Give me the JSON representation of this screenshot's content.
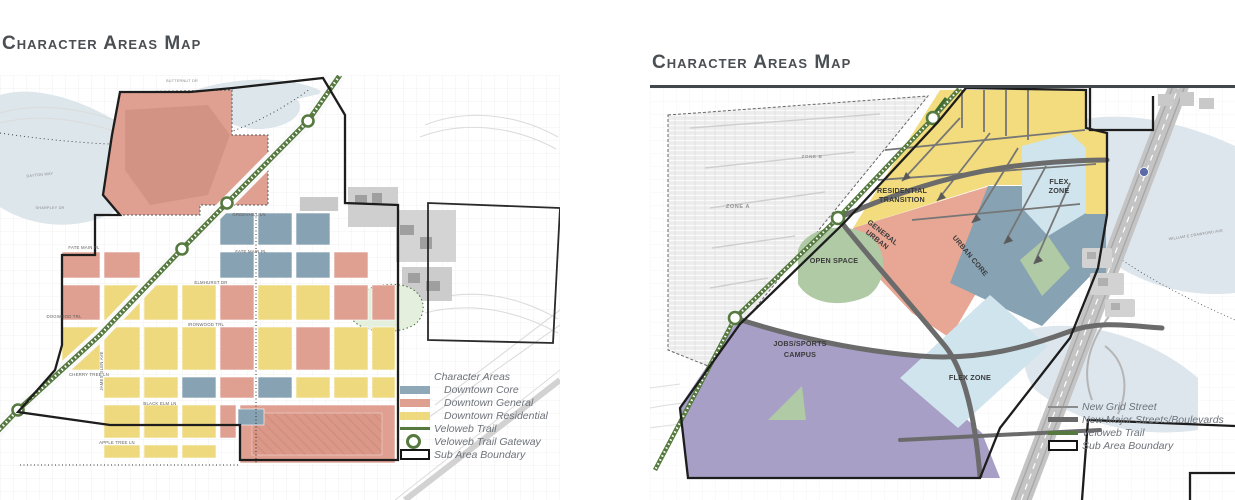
{
  "left_map": {
    "title": "Character Areas Map",
    "legend": {
      "header": "Character Areas",
      "downtown_core": "Downtown Core",
      "downtown_general": "Downtown General",
      "downtown_residential": "Downtown Residential",
      "veloweb_trail": "Veloweb Trail",
      "veloweb_trail_gateway": "Veloweb Trail Gateway",
      "sub_area_boundary": "Sub Area Boundary"
    },
    "streets": {
      "butternut": "BUTTERNUT DR",
      "dayton": "DAYTON WAY",
      "sharpley": "SHARPLEY DR",
      "fate_main": "FATE MAIN PL",
      "greenhill": "GREENHILL LN",
      "elmhurst": "ELMHURST DR",
      "ironwood": "IRONWOOD TRL",
      "dogwood": "DOGWOOD TRL",
      "cherry_tree": "CHERRY TREE LN",
      "black_elm": "BLACK ELM LN",
      "apple_tree": "APPLE TREE LN",
      "james_glen": "JAMES GLEN AVE"
    }
  },
  "right_map": {
    "title": "Character Areas Map",
    "zones": {
      "residential_transition": [
        "RESIDENTIAL",
        "TRANSITION"
      ],
      "general_urban": [
        "GENERAL",
        "URBAN"
      ],
      "urban_core": "URBAN CORE",
      "flex_zone_top": [
        "FLEX",
        "ZONE"
      ],
      "flex_zone_bottom": "FLEX ZONE",
      "open_space": "OPEN SPACE",
      "jobs_sports_campus": [
        "JOBS/SPORTS",
        "CAMPUS"
      ],
      "zone_a": "ZONE A",
      "zone_b": "ZONE B"
    },
    "streets": {
      "crawford": "WILLIAM E CRAWFORD AVE"
    },
    "legend": {
      "new_grid_street": "New Grid Street",
      "new_major_streets": "New Major Streets/Boulevards",
      "veloweb_trail": "Veloweb Trail",
      "sub_area_boundary": "Sub Area Boundary"
    }
  },
  "colors": {
    "downtown_core": "#8fa8b8",
    "downtown_general": "#dfa091",
    "downtown_residential": "#eed97e",
    "urban_core": "#87a2b3",
    "general_urban": "#e8a795",
    "residential_transition": "#f2dc7d",
    "flex_zone": "#cfe4ed",
    "open_space": "#afcaa5",
    "jobs_sports_campus": "#a79fc6",
    "veloweb_green": "#55793f",
    "road_gray": "#6b6b6b",
    "title_gray": "#4a4f54"
  }
}
